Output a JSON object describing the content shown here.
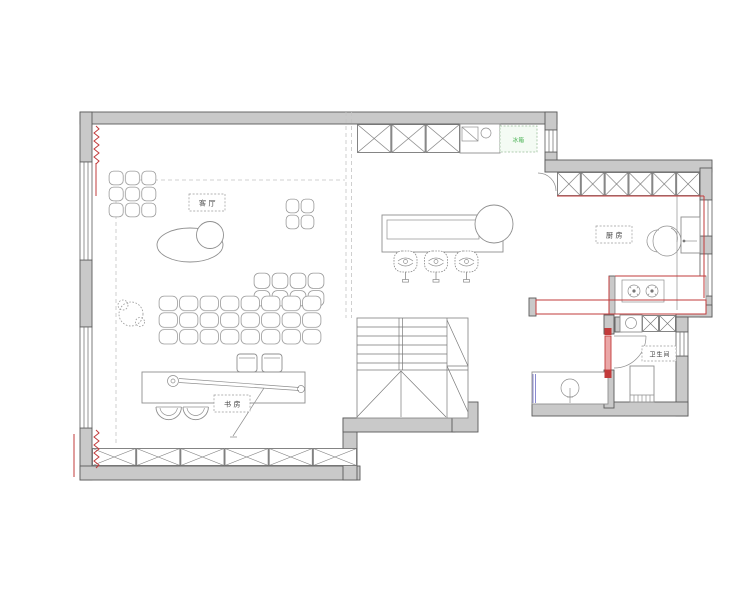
{
  "plan": {
    "labels": {
      "living_room": "客厅",
      "kitchen": "厨房",
      "bathroom": "卫生间",
      "study": "书房",
      "fridge": "冰箱"
    },
    "colors": {
      "wall_fill": "#c9c9c9",
      "accent_red": "#c23b3b",
      "door_fill": "#eaa7a7",
      "green": "#3fae4a",
      "blue": "#8a8ad0"
    }
  }
}
